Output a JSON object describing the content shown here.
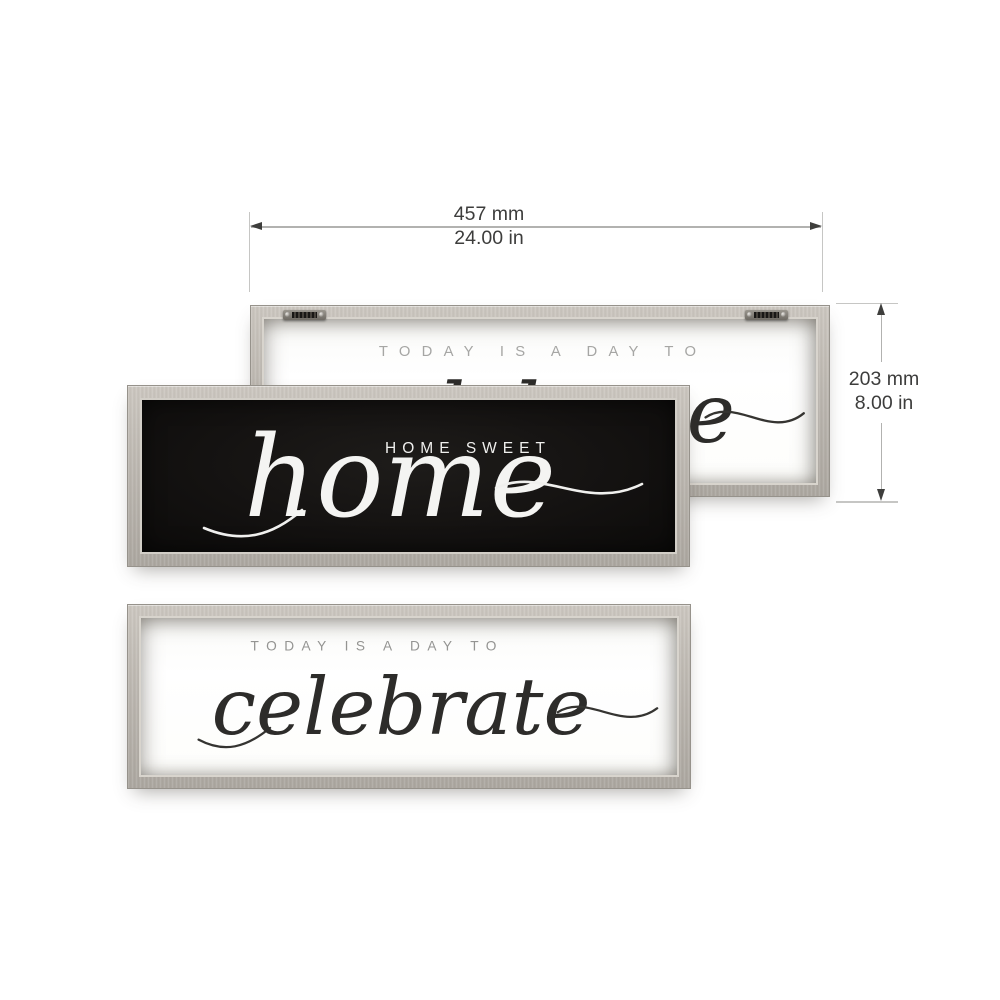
{
  "dimensions": {
    "width": {
      "metric": "457 mm",
      "imperial": "24.00 in"
    },
    "height": {
      "metric": "203 mm",
      "imperial": "8.00 in"
    }
  },
  "signs": {
    "celebrate": {
      "caption": "TODAY IS A DAY TO",
      "script": "celebrate"
    },
    "home_sweet_home": {
      "caption": "HOME SWEET",
      "script": "home"
    }
  },
  "colors": {
    "background": "#ffffff",
    "frame_wood": "#b8b3ac",
    "frame_wood_highlight": "#d2cdc6",
    "frame_border": "#96928b",
    "black_panel": "#141211",
    "white_panel": "#fdfdfc",
    "caption_gray": "#9a9a98",
    "script_ink": "#2d2c2a",
    "script_white": "#f4f4f2",
    "dimension_line": "#b2b2b0",
    "dimension_text": "#3d3d3c",
    "hanger_metal": "#46423c"
  }
}
